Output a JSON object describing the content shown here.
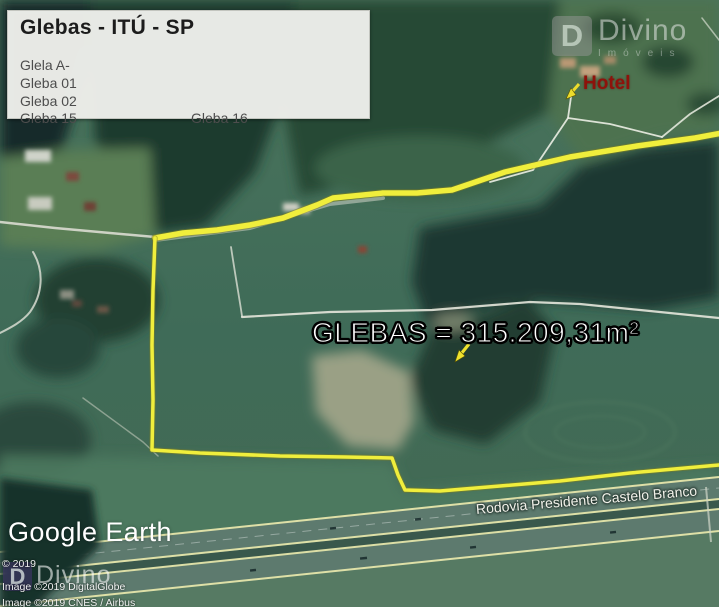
{
  "info_box": {
    "title": "Glebas - ITÚ - SP",
    "items": [
      "Glela A-",
      "Gleba 01",
      "Gleba 02",
      "Gleba 15",
      "Gleba 16"
    ]
  },
  "map_labels": {
    "area_label": "GLEBAS = 315.209,31m²",
    "hotel_label": "Hotel",
    "road_label": "Rodovia Presidente Castelo Branco",
    "google_earth_logo": "Google Earth"
  },
  "watermarks": {
    "top_right": {
      "monogram": "D",
      "brand": "Divino",
      "subtitle": "Imóveis"
    },
    "bottom_left": {
      "monogram": "D",
      "brand": "Divino"
    }
  },
  "attribution": {
    "line1": "© 2019",
    "line2": "Image ©2019 DigitalGlobe",
    "line3": "Image ©2019 CNES / Airbus"
  },
  "icons": {
    "area_pointer": "yellow-arrow-down-left",
    "hotel_pointer": "yellow-arrow-down-left"
  },
  "colors": {
    "boundary_yellow": "#F0EE3C",
    "hotel_red": "#8E120B",
    "label_white": "#FFFFFF",
    "field_green": "#41695A",
    "forest_dark": "#1B3831",
    "highway_gray": "#5D7A6E",
    "info_box_bg": "#ECEDE9"
  }
}
